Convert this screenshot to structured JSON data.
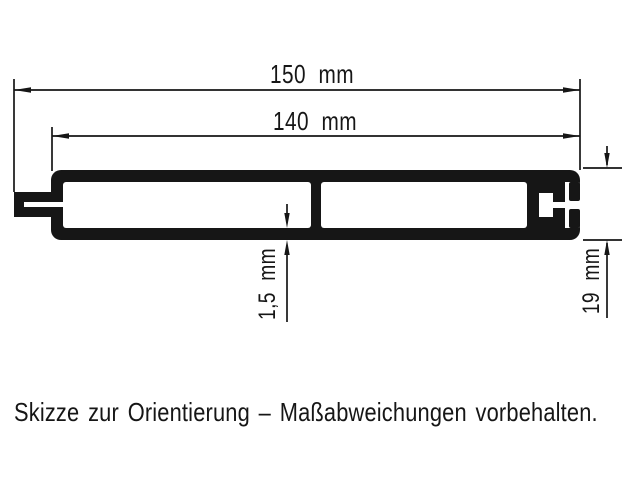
{
  "drawing": {
    "title_hint": "profile cross-section sketch",
    "dimensions": {
      "total_width": {
        "label": "150 mm"
      },
      "body_width": {
        "label": "140 mm"
      },
      "wall_thickness": {
        "label": "1,5 mm"
      },
      "height": {
        "label": "19 mm"
      }
    },
    "note": "Skizze zur Orientierung – Maßabweichungen vorbehalten."
  },
  "colors": {
    "ink": "#161616",
    "background": "#ffffff"
  }
}
